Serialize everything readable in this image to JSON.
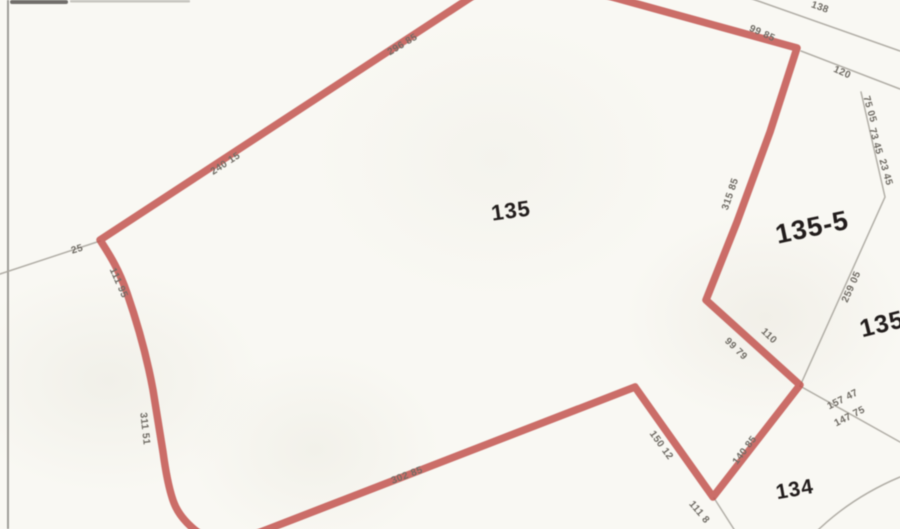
{
  "map": {
    "title": "plat parcel map",
    "parcels": [
      {
        "id": "135-main",
        "label": "135"
      },
      {
        "id": "135-5",
        "label": "135-5"
      },
      {
        "id": "135-east",
        "label": "135"
      },
      {
        "id": "134",
        "label": "134"
      }
    ],
    "dimensions": [
      {
        "value": "240 15"
      },
      {
        "value": "296 85"
      },
      {
        "value": "99 85"
      },
      {
        "value": "138"
      },
      {
        "value": "120"
      },
      {
        "value": "75 05"
      },
      {
        "value": "73 45"
      },
      {
        "value": "23 45"
      },
      {
        "value": "315 85"
      },
      {
        "value": "259 05"
      },
      {
        "value": "110"
      },
      {
        "value": "99 79"
      },
      {
        "value": "157 47"
      },
      {
        "value": "147 75"
      },
      {
        "value": "140 85"
      },
      {
        "value": "150 12"
      },
      {
        "value": "111 8"
      },
      {
        "value": "302 85"
      },
      {
        "value": "311 51"
      },
      {
        "value": "111 95"
      },
      {
        "value": "25"
      }
    ],
    "colors": {
      "boundary_red": "#c14f4a",
      "neighbor_gray": "#aaa69f",
      "dimension_text": "#6e6a63",
      "parcel_text": "#211f1c",
      "background": "#f9f8f3",
      "scan_edge": "#8f8c88"
    }
  }
}
